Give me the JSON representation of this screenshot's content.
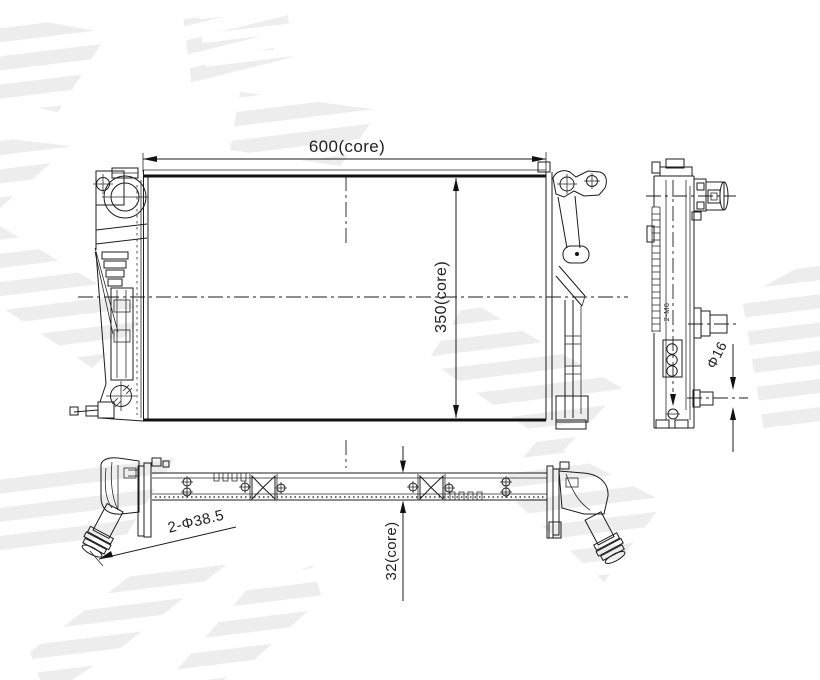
{
  "drawing": {
    "type": "radiator-engineering-drawing",
    "line_color": "#1c1c1c",
    "watermark_stripe_color": "#ededed",
    "background_color": "#ffffff"
  },
  "dimensions": {
    "core_width": "600(core)",
    "core_height": "350(core)",
    "core_depth": "32(core)",
    "inlet_pipes": "2-Φ38.5",
    "outlet_pipe_diameter": "Φ16",
    "mounting_thread": "2-M6"
  }
}
